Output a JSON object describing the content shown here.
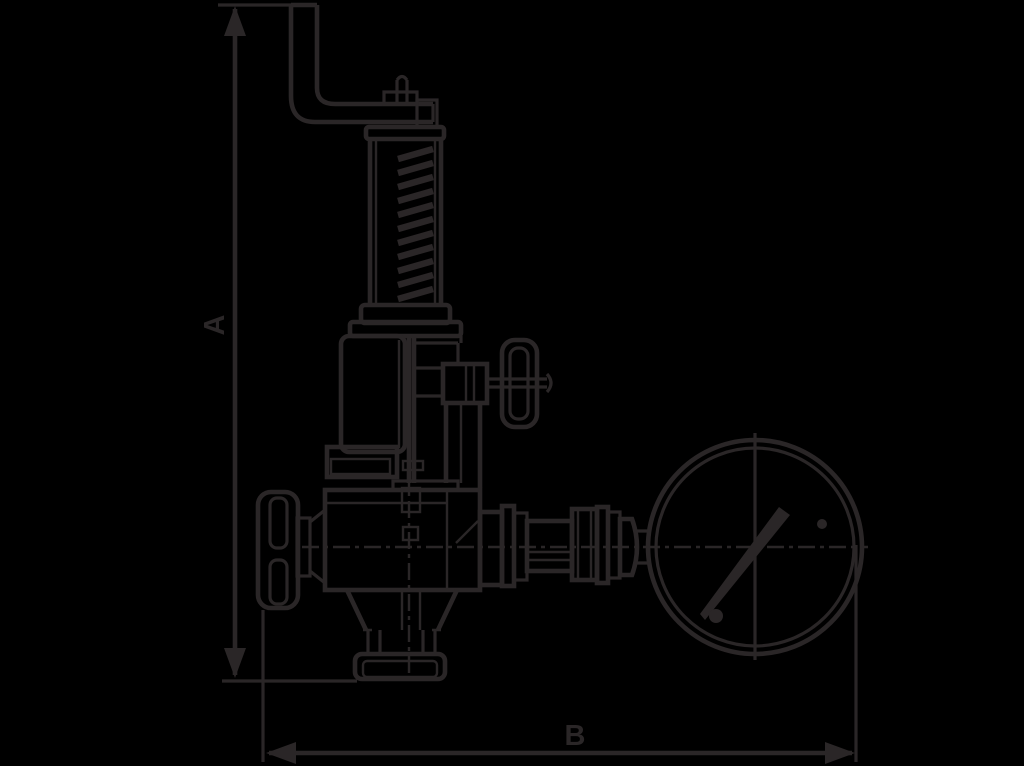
{
  "canvas": {
    "background_color": "#000000",
    "ink_color": "#2a2627",
    "width": 1024,
    "height": 766
  },
  "drawing": {
    "kind": "technical-dimension-drawing",
    "subject": "spring-loaded valve with easing lever, shut-off handwheels and pressure gauge"
  },
  "dimensions": {
    "vertical": {
      "label": "A"
    },
    "horizontal": {
      "label": "B"
    }
  }
}
